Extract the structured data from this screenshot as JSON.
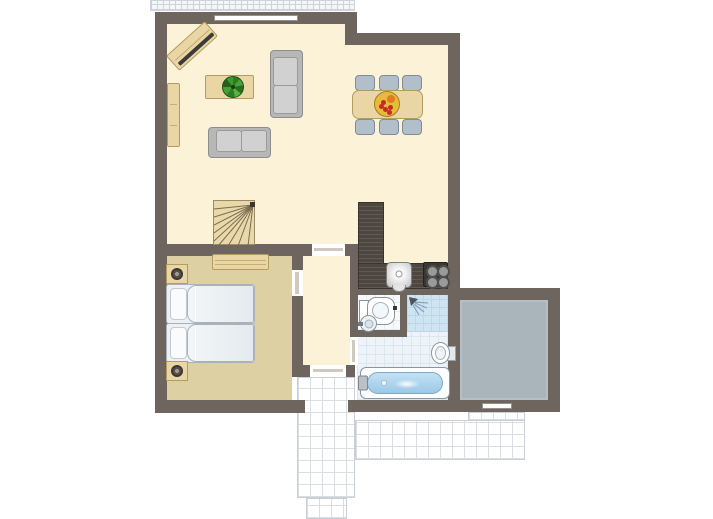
{
  "plan": {
    "kind": "apartment-floor-plan"
  },
  "colors": {
    "wall": "#6e655e",
    "floor_main": "#fcf2d7",
    "floor_bedroom": "#ddd1a4",
    "wood": "#e9d6a4",
    "wood_edge": "#b39c60",
    "counter": "#4e4741",
    "sofa_frame": "#b7b7b7",
    "sofa_cushion": "#d1d1d1",
    "chair": "#b2bec9",
    "chair_edge": "#7f8c98",
    "bath_tile": "#edf3f8",
    "bath_grid": "#dbe7ef",
    "shower_tile": "#cfe4f1",
    "shower_grid": "#bcd7e7",
    "wc_floor": "#f7fafc",
    "gray_floor": "#a9b4bb",
    "terrace_grid": "#d9dee3",
    "water": "#9cc9e7",
    "plant_green": "#3b8a2e",
    "fruit_base": "#e7b93f",
    "fruit_red": "#c92a22",
    "fruit_orange": "#e07b1f",
    "fruit_yellow": "#d9c62f"
  },
  "floors": {
    "living_a": {
      "x": 167,
      "y": 24,
      "w": 178,
      "h": 220
    },
    "living_b": {
      "x": 345,
      "y": 45,
      "w": 103,
      "h": 199
    },
    "kitchen": {
      "x": 358,
      "y": 244,
      "w": 90,
      "h": 44
    },
    "hallway": {
      "x": 303,
      "y": 256,
      "w": 47,
      "h": 109
    },
    "bedroom": {
      "x": 167,
      "y": 256,
      "w": 125,
      "h": 144
    },
    "bathroom": {
      "x": 357,
      "y": 295,
      "w": 91,
      "h": 105
    },
    "wc": {
      "x": 357,
      "y": 295,
      "w": 43,
      "h": 35
    },
    "shower": {
      "x": 407,
      "y": 295,
      "w": 41,
      "h": 37
    },
    "gray_room": {
      "x": 460,
      "y": 300,
      "w": 88,
      "h": 100
    }
  },
  "terrace": {
    "balcony_top": {
      "x": 150,
      "y": 0,
      "w": 205,
      "h": 11
    },
    "vertical": {
      "x": 297,
      "y": 377,
      "w": 58,
      "h": 121
    },
    "stub": {
      "x": 306,
      "y": 498,
      "w": 41,
      "h": 21
    },
    "band_top": {
      "x": 468,
      "y": 412,
      "w": 57,
      "h": 9
    },
    "band": {
      "x": 355,
      "y": 420,
      "w": 170,
      "h": 40
    }
  },
  "walls": {
    "outer_top_a": {
      "x": 155,
      "y": 12,
      "w": 202,
      "h": 12
    },
    "outer_step": {
      "x": 345,
      "y": 12,
      "w": 12,
      "h": 33
    },
    "outer_top_b": {
      "x": 345,
      "y": 33,
      "w": 115,
      "h": 12
    },
    "outer_left": {
      "x": 155,
      "y": 12,
      "w": 12,
      "h": 401
    },
    "outer_right": {
      "x": 448,
      "y": 33,
      "w": 12,
      "h": 379
    },
    "bedroom_bottom": {
      "x": 155,
      "y": 400,
      "w": 150,
      "h": 13
    },
    "bath_bottom": {
      "x": 348,
      "y": 400,
      "w": 112,
      "h": 12
    },
    "divider_a": {
      "x": 155,
      "y": 244,
      "w": 157,
      "h": 12
    },
    "divider_b": {
      "x": 345,
      "y": 244,
      "w": 13,
      "h": 12
    },
    "hall_left_a": {
      "x": 292,
      "y": 256,
      "w": 11,
      "h": 14
    },
    "hall_left_b": {
      "x": 292,
      "y": 296,
      "w": 11,
      "h": 81
    },
    "hall_bottom_a": {
      "x": 292,
      "y": 365,
      "w": 18,
      "h": 12
    },
    "hall_bottom_b": {
      "x": 346,
      "y": 365,
      "w": 9,
      "h": 12
    },
    "hall_right": {
      "x": 350,
      "y": 256,
      "w": 8,
      "h": 81
    },
    "wc_bottom": {
      "x": 350,
      "y": 330,
      "w": 57,
      "h": 7
    },
    "wc_divider": {
      "x": 400,
      "y": 295,
      "w": 7,
      "h": 35
    },
    "bath_top": {
      "x": 350,
      "y": 288,
      "w": 110,
      "h": 7
    },
    "gray_top": {
      "x": 448,
      "y": 288,
      "w": 112,
      "h": 12
    },
    "gray_right": {
      "x": 548,
      "y": 288,
      "w": 12,
      "h": 124
    },
    "gray_bottom": {
      "x": 448,
      "y": 400,
      "w": 112,
      "h": 12
    }
  },
  "openings": {
    "gap_living_hall": {
      "x": 312,
      "y": 244,
      "w": 33,
      "h": 12
    },
    "gap_bedroom": {
      "x": 292,
      "y": 270,
      "w": 11,
      "h": 26
    },
    "gap_hall_out": {
      "x": 310,
      "y": 365,
      "w": 36,
      "h": 12
    },
    "gap_bathroom": {
      "x": 350,
      "y": 337,
      "w": 8,
      "h": 28
    },
    "th_living_hall": {
      "x": 314,
      "y": 248,
      "w": 29,
      "h": 3
    },
    "th_bedroom": {
      "x": 295,
      "y": 272,
      "w": 4,
      "h": 22
    },
    "th_hall_out": {
      "x": 313,
      "y": 369,
      "w": 30,
      "h": 3
    },
    "th_bathroom": {
      "x": 352,
      "y": 340,
      "w": 3,
      "h": 22
    }
  },
  "windows": {
    "living": {
      "x": 214,
      "y": 15,
      "w": 84,
      "h": 6
    },
    "gray_room": {
      "x": 482,
      "y": 403,
      "w": 30,
      "h": 6
    }
  },
  "furniture": {
    "tv_unit": {
      "x": 166,
      "y": 36,
      "w": 52,
      "h": 20,
      "rot": -42
    },
    "sideboard": {
      "x": 167,
      "y": 83,
      "w": 13,
      "h": 64
    },
    "coffee_table": {
      "x": 205,
      "y": 75,
      "w": 49,
      "h": 24
    },
    "plant": {
      "x": 222,
      "y": 76,
      "w": 22,
      "h": 22
    },
    "sofa_side": {
      "x": 270,
      "y": 50,
      "w": 33,
      "h": 68
    },
    "sofa_front": {
      "x": 208,
      "y": 127,
      "w": 63,
      "h": 31
    },
    "dining_table": {
      "x": 352,
      "y": 90,
      "w": 71,
      "h": 29
    },
    "fruit_bowl": {
      "x": 374,
      "y": 91,
      "w": 26,
      "h": 26
    },
    "chair_t1": {
      "x": 355,
      "y": 75,
      "w": 20,
      "h": 16
    },
    "chair_t2": {
      "x": 379,
      "y": 75,
      "w": 20,
      "h": 16
    },
    "chair_t3": {
      "x": 402,
      "y": 75,
      "w": 20,
      "h": 16
    },
    "chair_b1": {
      "x": 355,
      "y": 119,
      "w": 20,
      "h": 16
    },
    "chair_b2": {
      "x": 379,
      "y": 119,
      "w": 20,
      "h": 16
    },
    "chair_b3": {
      "x": 402,
      "y": 119,
      "w": 20,
      "h": 16
    },
    "stairs": {
      "x": 213,
      "y": 200,
      "w": 42,
      "h": 45
    },
    "wardrobe": {
      "x": 212,
      "y": 254,
      "w": 57,
      "h": 16
    },
    "bed": {
      "x": 166,
      "y": 284,
      "w": 87,
      "h": 77
    },
    "nightstand_1": {
      "x": 166,
      "y": 264,
      "w": 22,
      "h": 20
    },
    "nightstand_2": {
      "x": 166,
      "y": 361,
      "w": 22,
      "h": 20
    },
    "kitchen_column": {
      "x": 358,
      "y": 202,
      "w": 26,
      "h": 62
    },
    "kitchen_counter": {
      "x": 358,
      "y": 263,
      "w": 90,
      "h": 26
    },
    "kitchen_sink": {
      "x": 386,
      "y": 262,
      "w": 26,
      "h": 26
    },
    "stove": {
      "x": 423,
      "y": 262,
      "w": 25,
      "h": 25
    },
    "toilet": {
      "x": 359,
      "y": 297,
      "w": 35,
      "h": 26
    },
    "toilet_dot": {
      "x": 393,
      "y": 306,
      "w": 4,
      "h": 4
    },
    "wc_sink": {
      "x": 360,
      "y": 315,
      "w": 17,
      "h": 17
    },
    "shower_head": {
      "x": 408,
      "y": 296,
      "w": 22,
      "h": 22
    },
    "wall_sink": {
      "x": 431,
      "y": 342,
      "w": 25,
      "h": 21
    },
    "bathtub": {
      "x": 360,
      "y": 367,
      "w": 90,
      "h": 32
    }
  }
}
